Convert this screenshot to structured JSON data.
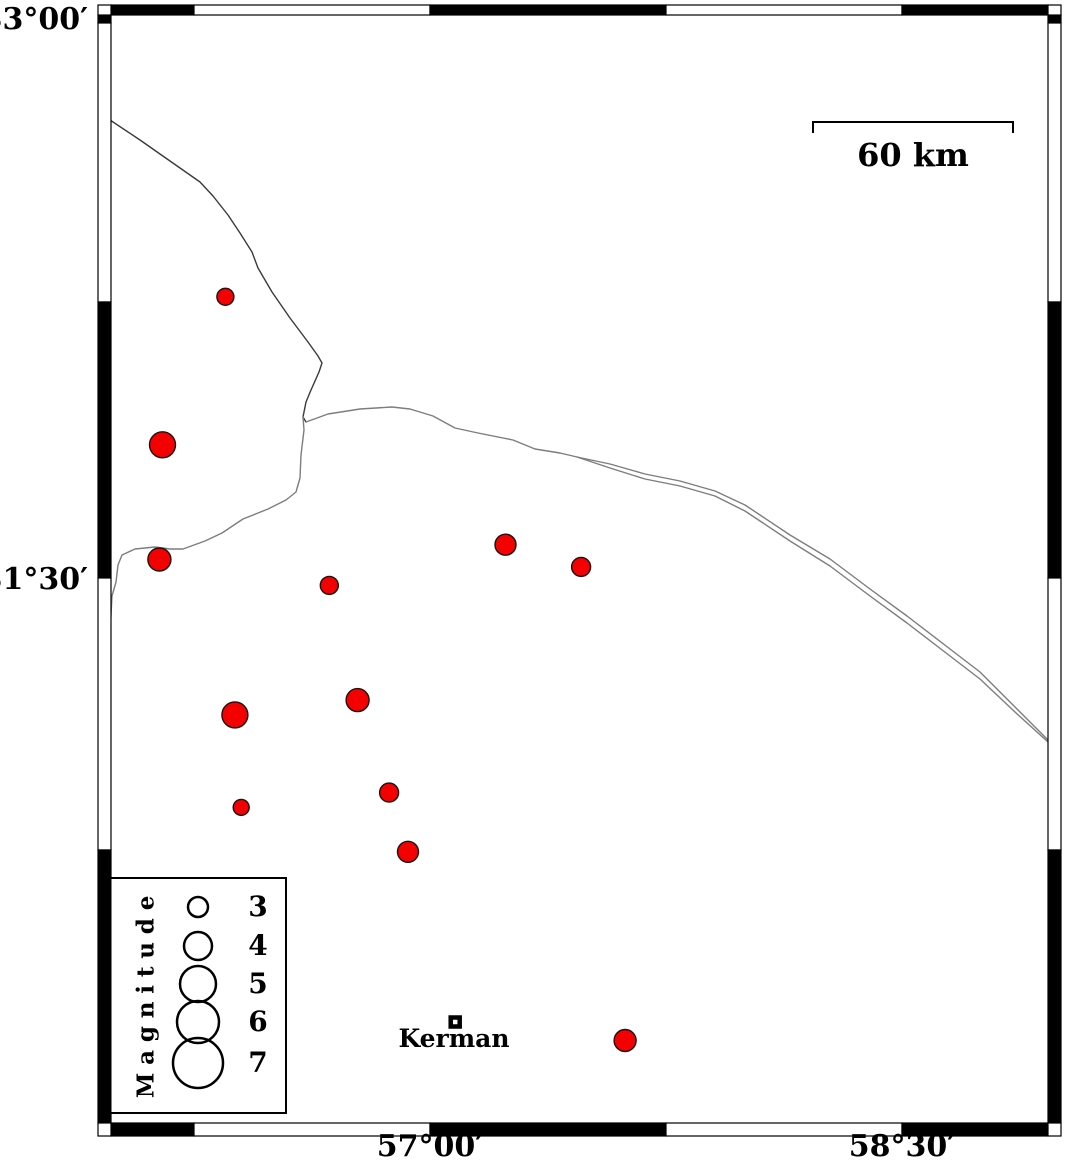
{
  "page": {
    "background": "#ffffff"
  },
  "axes": {
    "left_labels": [
      {
        "text": "33°00′"
      },
      {
        "text": "31°30′"
      }
    ],
    "bottom_labels": [
      {
        "text": "57°00′"
      },
      {
        "text": "58°30′"
      }
    ]
  },
  "scale_bar": {
    "label": "60 km",
    "length_px": 200
  },
  "city": {
    "label": "Kerman",
    "lon": 57.08,
    "lat": 30.3
  },
  "legend": {
    "title": "Magnitude",
    "entries": [
      {
        "label": "3",
        "radius_px": 10
      },
      {
        "label": "4",
        "radius_px": 14
      },
      {
        "label": "5",
        "radius_px": 18
      },
      {
        "label": "6",
        "radius_px": 21
      },
      {
        "label": "7",
        "radius_px": 25
      }
    ]
  },
  "colors": {
    "earthquake_fill": "#f40000",
    "earthquake_stroke": "#151515",
    "frame": "#000000",
    "fault_dark": "#3a3a3a",
    "fault_gray": "#7d7d7d"
  },
  "map_data": {
    "type": "map",
    "region": {
      "lon_min": 56.0,
      "lon_max": 58.97,
      "lat_min": 30.0,
      "lat_max": 33.03
    },
    "projection": {
      "lon0": 57,
      "x0": 430,
      "px_per_deg_lon": 314.7,
      "lat0": 31.5,
      "y0": 578,
      "px_per_deg_lat": 370
    },
    "earthquakes": [
      {
        "lon": 56.35,
        "lat": 32.26,
        "r_px": 8.5
      },
      {
        "lon": 56.15,
        "lat": 31.86,
        "r_px": 13
      },
      {
        "lon": 56.14,
        "lat": 31.55,
        "r_px": 11.5
      },
      {
        "lon": 56.68,
        "lat": 31.48,
        "r_px": 9
      },
      {
        "lon": 57.24,
        "lat": 31.59,
        "r_px": 10.5
      },
      {
        "lon": 57.48,
        "lat": 31.53,
        "r_px": 9.5
      },
      {
        "lon": 56.77,
        "lat": 31.17,
        "r_px": 11.5
      },
      {
        "lon": 56.38,
        "lat": 31.13,
        "r_px": 13
      },
      {
        "lon": 56.87,
        "lat": 30.92,
        "r_px": 9.5
      },
      {
        "lon": 56.4,
        "lat": 30.88,
        "r_px": 8
      },
      {
        "lon": 56.93,
        "lat": 30.76,
        "r_px": 10.5
      },
      {
        "lon": 57.62,
        "lat": 30.25,
        "r_px": 11
      }
    ],
    "fault_lines": [
      {
        "name": "fault-line-northwest",
        "color": "#3a3a3a",
        "width": 1.4,
        "points": [
          [
            110,
            120
          ],
          [
            140,
            140
          ],
          [
            180,
            168
          ],
          [
            200,
            182
          ],
          [
            213,
            196
          ],
          [
            228,
            215
          ],
          [
            240,
            233
          ],
          [
            252,
            252
          ],
          [
            258,
            268
          ],
          [
            272,
            292
          ],
          [
            290,
            318
          ],
          [
            308,
            342
          ],
          [
            318,
            356
          ],
          [
            322,
            363
          ],
          [
            319,
            372
          ],
          [
            311,
            390
          ],
          [
            306,
            402
          ],
          [
            303,
            417
          ],
          [
            306,
            422
          ]
        ]
      },
      {
        "name": "fault-line-west-branch",
        "color": "#7d7d7d",
        "width": 1.4,
        "points": [
          [
            303,
            417
          ],
          [
            304,
            430
          ],
          [
            301,
            455
          ],
          [
            300,
            478
          ],
          [
            296,
            492
          ],
          [
            286,
            500
          ],
          [
            268,
            509
          ],
          [
            243,
            519
          ],
          [
            222,
            533
          ],
          [
            205,
            541
          ],
          [
            183,
            549
          ],
          [
            170,
            549
          ],
          [
            155,
            547
          ],
          [
            135,
            549
          ],
          [
            122,
            555
          ],
          [
            118,
            565
          ],
          [
            116,
            582
          ],
          [
            112,
            596
          ],
          [
            111,
            615
          ],
          [
            110,
            632
          ]
        ]
      },
      {
        "name": "fault-line-east-main",
        "color": "#7d7d7d",
        "width": 1.4,
        "points": [
          [
            306,
            422
          ],
          [
            328,
            414
          ],
          [
            360,
            409
          ],
          [
            392,
            407
          ],
          [
            410,
            409
          ],
          [
            433,
            416
          ],
          [
            455,
            428
          ],
          [
            478,
            433
          ],
          [
            513,
            440
          ],
          [
            535,
            449
          ],
          [
            560,
            453
          ],
          [
            577,
            457
          ],
          [
            610,
            468
          ],
          [
            645,
            479
          ],
          [
            680,
            486
          ],
          [
            715,
            496
          ],
          [
            745,
            511
          ],
          [
            790,
            541
          ],
          [
            830,
            566
          ],
          [
            870,
            596
          ],
          [
            907,
            623
          ],
          [
            950,
            656
          ],
          [
            980,
            679
          ],
          [
            1015,
            712
          ],
          [
            1048,
            742
          ]
        ]
      },
      {
        "name": "fault-line-east-parallel",
        "color": "#7d7d7d",
        "width": 1.4,
        "points": [
          [
            577,
            457
          ],
          [
            610,
            464
          ],
          [
            645,
            474
          ],
          [
            680,
            481
          ],
          [
            715,
            491
          ],
          [
            745,
            505
          ],
          [
            790,
            535
          ],
          [
            830,
            559
          ],
          [
            870,
            589
          ],
          [
            907,
            616
          ],
          [
            950,
            649
          ],
          [
            980,
            672
          ],
          [
            1015,
            707
          ],
          [
            1048,
            740
          ]
        ]
      }
    ]
  }
}
